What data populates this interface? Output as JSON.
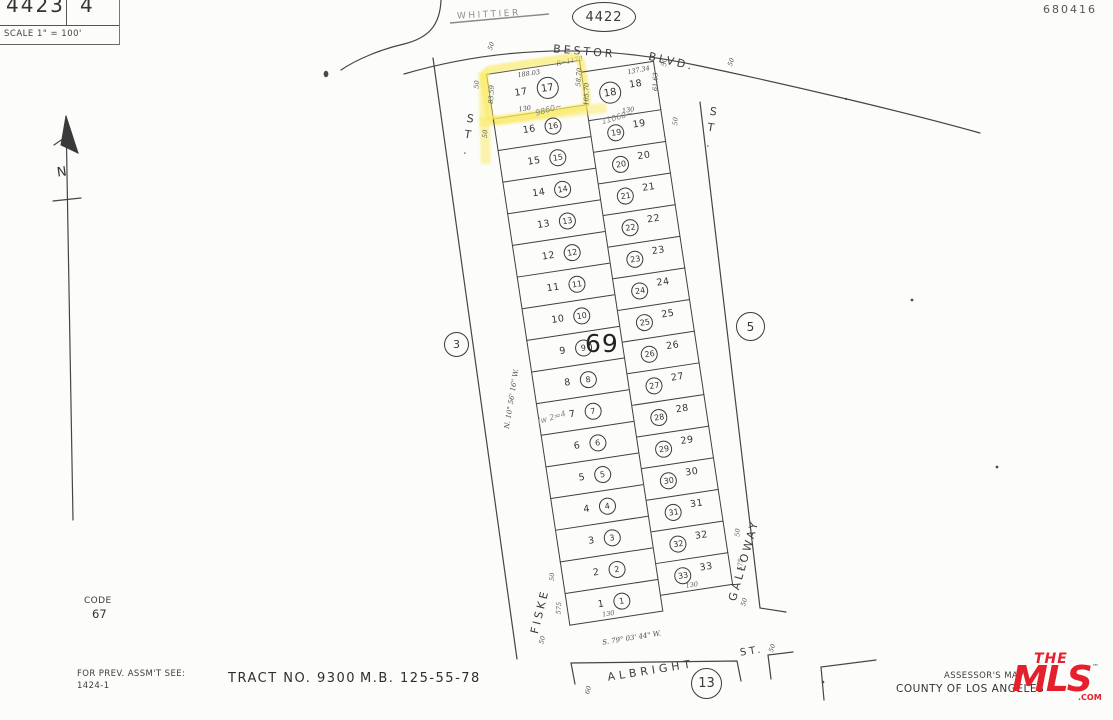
{
  "page": {
    "bg": "#fcfcfa",
    "ink": "#3a3a3a",
    "highlight": "#fae95c",
    "logo_red": "#e4202c"
  },
  "header": {
    "sheet_left": "4423",
    "sheet_right": "4",
    "scale_note": "SCALE 1\" = 100'",
    "adjacent_page_top": "4422",
    "cutoff_street_top": "WHITTIER",
    "handwritten_id": "680416",
    "north_letter": "N"
  },
  "streets": {
    "bestor": {
      "name": "BESTOR",
      "suffix": "BLVD.",
      "width_left": "50",
      "width_right": "50",
      "curve_radius": "R=1170"
    },
    "fiske": {
      "st": "ST.",
      "name": "FISKE",
      "width_bottom": "50"
    },
    "galloway": {
      "st": "ST.",
      "name": "GALLOWAY",
      "width_bottom": "50"
    },
    "albright": {
      "name": "ALBRIGHT",
      "st": "ST.",
      "width_left": "60",
      "width_right": "50"
    },
    "bearing_west": "N. 10° 56' 16\" W.",
    "bearing_south": "S. 79° 03' 44\" W."
  },
  "map": {
    "block_number": "69",
    "adjacent_page_left": "3",
    "adjacent_page_right": "5",
    "adjacent_page_bottom": "13",
    "code_label": "CODE",
    "code_value": "67",
    "lot17": {
      "number": "17",
      "top": "188.03",
      "left": "83.59",
      "right": "58.70",
      "bottom": "130",
      "handwritten": "9860~",
      "street_width": "50"
    },
    "lot18": {
      "number": "18",
      "top": "137.34",
      "left": "105.70",
      "right": "61.63",
      "bottom": "130",
      "handwritten": "11060~",
      "street_width": "50"
    },
    "left_lots": [
      "16",
      "15",
      "14",
      "13",
      "12",
      "11",
      "10",
      "9",
      "8",
      "7",
      "6",
      "5",
      "4",
      "3",
      "2",
      "1"
    ],
    "right_lots": [
      "19",
      "20",
      "21",
      "22",
      "23",
      "24",
      "25",
      "26",
      "27",
      "28",
      "29",
      "30",
      "31",
      "32",
      "33"
    ],
    "edge_marks": [
      {
        "lot": "16",
        "side": "left",
        "text": "50"
      },
      {
        "lot": "19",
        "side": "right",
        "text": "50"
      },
      {
        "lot": "2",
        "side": "left",
        "text": "50"
      },
      {
        "lot": "1",
        "side": "left",
        "text": "575"
      },
      {
        "lot": "1",
        "side": "bottom",
        "text": "130"
      },
      {
        "lot": "32",
        "side": "right",
        "text": "50"
      },
      {
        "lot": "33",
        "side": "right",
        "text": "575"
      },
      {
        "lot": "33",
        "side": "bottom",
        "text": "130"
      },
      {
        "lot": "7",
        "side": "hand",
        "text": "(w 2=4"
      }
    ]
  },
  "footer": {
    "prev_assmt_label": "FOR PREV. ASSM'T SEE:",
    "prev_assmt_ref": "1424-1",
    "tract": "TRACT  NO. 9300",
    "map_book": "M.B. 125-55-78",
    "assessor_line1": "ASSESSOR'S  MAP",
    "assessor_line2": "COUNTY  OF  LOS  ANGELES",
    "logo_the": "THE",
    "logo_mls": "MLS",
    "logo_com": ".COM",
    "logo_tm": "™"
  }
}
